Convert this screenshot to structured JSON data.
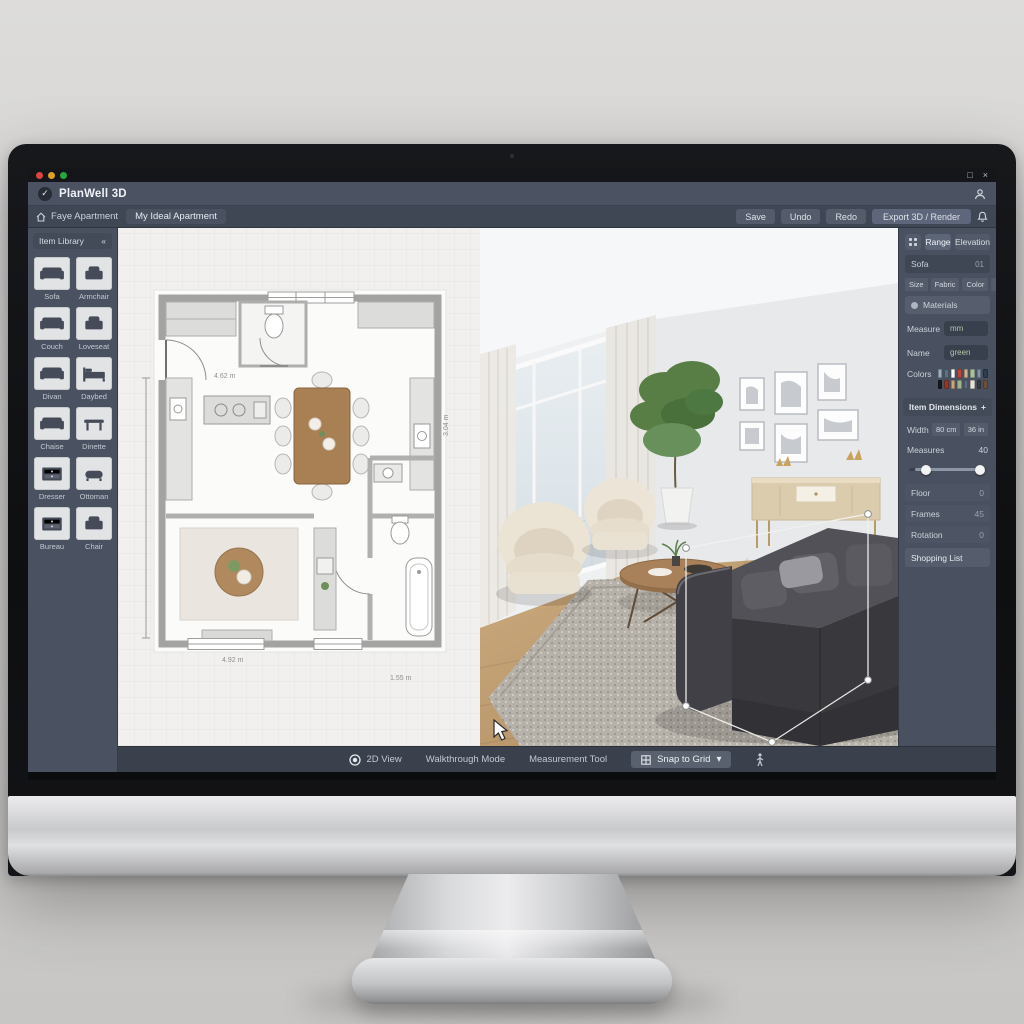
{
  "window": {
    "title": "PlanWell 3D",
    "maximize": "□",
    "close": "×"
  },
  "menubar": {
    "home_project": "Faye Apartment",
    "document": "My Ideal Apartment",
    "buttons": [
      "Save",
      "Undo",
      "Redo"
    ],
    "primary": "Export 3D / Render"
  },
  "sidebar": {
    "title": "Item Library",
    "collapse": "«",
    "items": [
      {
        "label": "Sofa",
        "glyph": "sofa"
      },
      {
        "label": "Armchair",
        "glyph": "armchair"
      },
      {
        "label": "Couch",
        "glyph": "sofa"
      },
      {
        "label": "Loveseat",
        "glyph": "armchair"
      },
      {
        "label": "Divan",
        "glyph": "sofa"
      },
      {
        "label": "Daybed",
        "glyph": "bed"
      },
      {
        "label": "Chaise",
        "glyph": "sofa"
      },
      {
        "label": "Dinette",
        "glyph": "table"
      },
      {
        "label": "Dresser",
        "glyph": "dresser"
      },
      {
        "label": "Ottoman",
        "glyph": "ottoman"
      },
      {
        "label": "Bureau",
        "glyph": "dresser"
      },
      {
        "label": "Chair",
        "glyph": "armchair"
      }
    ]
  },
  "floorplan": {
    "dim_top": "4.62 m",
    "dim_right": "3.04 m",
    "dim_living": "4.92 m",
    "dim_bottom": "1.55 m"
  },
  "rightpanel": {
    "tabs": [
      {
        "label": "Range",
        "active": true
      },
      {
        "label": "Elevation",
        "active": false
      }
    ],
    "item": {
      "label": "Sofa",
      "value": "01"
    },
    "chips": [
      "Size",
      "Fabric",
      "Color",
      "Finish"
    ],
    "materials_label": "Materials",
    "measure": {
      "label": "Measure",
      "value": "mm"
    },
    "name": {
      "label": "Name",
      "value": "green"
    },
    "colors_label": "Colors",
    "swatches": [
      "#9fb0c0",
      "#5d6f82",
      "#ffffff",
      "#c44536",
      "#d2b48c",
      "#a9c0a1",
      "#8294a6",
      "#2e3d4d",
      "#17191d",
      "#8b3a32",
      "#c9a97a",
      "#9fb58f",
      "#5e6e80",
      "#e8e4dd",
      "#3c3c40",
      "#6b4f3a"
    ],
    "dimensions_title": "Item Dimensions",
    "dimensions_expand": "+",
    "width": {
      "label": "Width",
      "chips": [
        "80 cm",
        "36 in"
      ]
    },
    "slider": {
      "label": "Measures",
      "value": "40"
    },
    "props": [
      {
        "label": "Floor",
        "value": "0"
      },
      {
        "label": "Frames",
        "value": "45"
      },
      {
        "label": "Rotation",
        "value": "0"
      }
    ],
    "footer_button": "Shopping List"
  },
  "bottombar": {
    "view": "2D View",
    "walkthrough": "Walkthrough Mode",
    "measure": "Measurement Tool",
    "snap": "Snap to Grid",
    "caret": "▾"
  },
  "colors": {
    "titlebar": "#4b5362",
    "menubar": "#3f4654",
    "panel": "#49505f",
    "canvas": "#f1f0ee",
    "toolbar": "#3a404c",
    "sofa": "#46464b",
    "wood_floor": "#b99a72",
    "plan_wood": "#a97f54"
  }
}
